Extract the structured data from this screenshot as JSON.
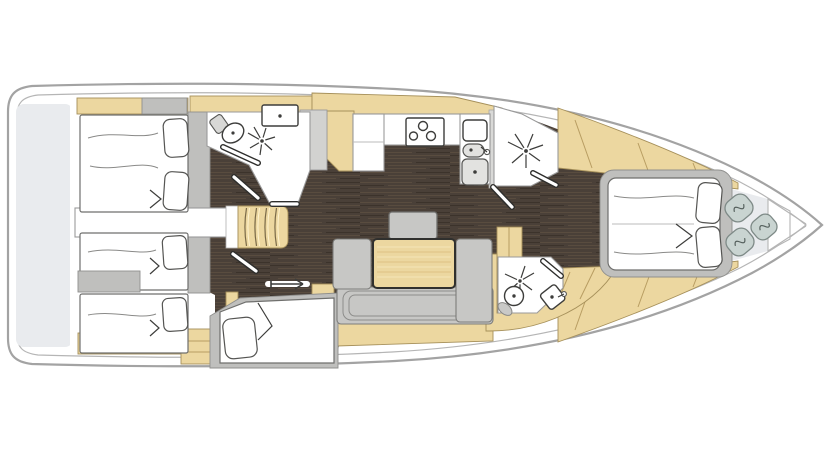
{
  "diagram": {
    "type": "sailing yacht interior floor plan, top view",
    "orientation": "bow pointing right, stern at left",
    "regions": [
      {
        "name": "aft-deck-platform",
        "items": []
      },
      {
        "name": "port-aft-double-cabin",
        "items": [
          "double-bed",
          "two-pillows",
          "shelf-band"
        ]
      },
      {
        "name": "starboard-aft-twin-cabin",
        "items": [
          "berth-upper",
          "berth-lower",
          "seat-locker",
          "drawer-unit"
        ]
      },
      {
        "name": "aft-head-port",
        "items": [
          "toilet",
          "washbasin",
          "shower-spray",
          "shower-door",
          "entry-door"
        ]
      },
      {
        "name": "companionway",
        "items": [
          "stairs",
          "engine-compartment"
        ]
      },
      {
        "name": "skipper-berth-cabin",
        "items": [
          "single-berth",
          "pillow",
          "sliding-door-arrow",
          "wardrobe"
        ]
      },
      {
        "name": "galley",
        "items": [
          "u-counter",
          "stove-three-burner",
          "double-sink",
          "faucet",
          "top-loading-fridge",
          "locker",
          "wardrobe"
        ]
      },
      {
        "name": "forward-shower-room",
        "items": [
          "shower-spray",
          "shower-door",
          "entry-door"
        ]
      },
      {
        "name": "salon",
        "items": [
          "u-shaped-sofa",
          "dining-table",
          "stool-seat",
          "side-cabinet",
          "nav-cabinet",
          "under-sofa-shelf"
        ]
      },
      {
        "name": "forward-head-starboard",
        "items": [
          "toilet",
          "washbasin",
          "shower-spray",
          "entry-door"
        ]
      },
      {
        "name": "owner-cabin-forward",
        "items": [
          "island-double-bed",
          "two-pillows",
          "tapering-side-shelves"
        ]
      },
      {
        "name": "bow-compartment",
        "items": [
          "cushion-pouf",
          "cushion-pouf",
          "cushion-pouf"
        ]
      }
    ]
  },
  "palette": {
    "hull_line": "#a3a3a3",
    "inner_hull_line": "#b5b5b5",
    "deck_gray": "#e9ebee",
    "floor_wood_dark": "#4a4038",
    "floor_streak_light": "#594c3f",
    "floor_streak_dark": "#3c332b",
    "furniture_wood_tan": "#ecd7a0",
    "wood_edge": "#a6905a",
    "upholstery_gray": "#c7c7c5",
    "wall_gray": "#bfbfbd",
    "mattress_white": "#ffffff",
    "pouf_gray_green": "#c9d4d1",
    "fixture_line": "#3d3d3b"
  }
}
